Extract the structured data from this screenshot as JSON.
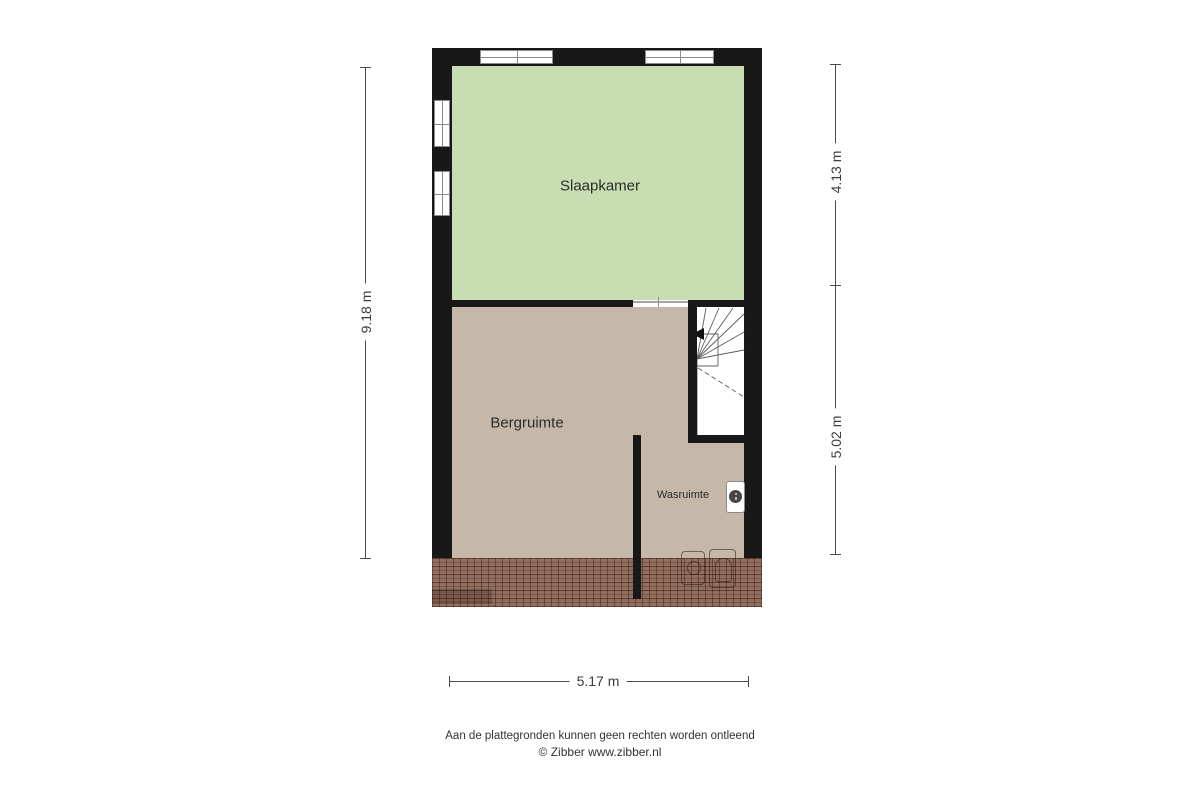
{
  "plan": {
    "room_labels": {
      "slaapkamer": "Slaapkamer",
      "bergruimte": "Bergruimte",
      "wasruimte": "Wasruimte"
    },
    "dimensions": {
      "height_total": "9.18 m",
      "height_top": "4.13 m",
      "height_bottom": "5.02 m",
      "width_bottom": "5.17 m"
    },
    "colors": {
      "slaapkamer_fill": "#c8deb2",
      "floor_fill": "#c5b8a8",
      "wall": "#181818",
      "roof_tile": "#916e5d",
      "dimension_line": "#4a4a4a"
    },
    "icons": [
      "stairs-winder-icon",
      "stairs-direction-arrow-icon",
      "boiler-icon",
      "roof-window-icon",
      "roof-chimney-icon",
      "window-icon"
    ]
  },
  "footer": {
    "disclaimer": "Aan de plattegronden kunnen geen rechten worden ontleend",
    "credit": "© Zibber www.zibber.nl"
  }
}
